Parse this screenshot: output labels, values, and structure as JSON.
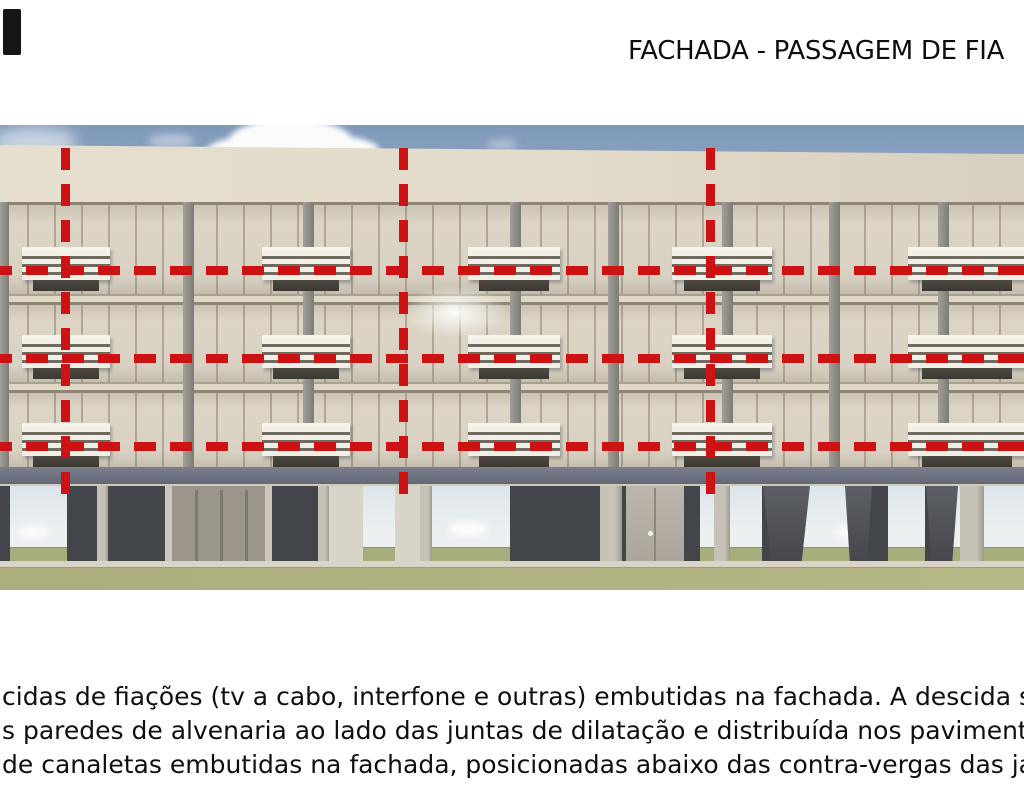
{
  "title": {
    "text": "FACHADA - PASSAGEM DE FIA"
  },
  "figure": {
    "type": "architectural-facade-render",
    "annotation": {
      "color": "#cd1213",
      "horizontal_lines_y": [
        270,
        358,
        446
      ],
      "vertical_lines_x": [
        65,
        403,
        710
      ],
      "vertical_line_top": 148,
      "vertical_line_bottom": 497,
      "dash_length": 22,
      "dash_gap": 14,
      "line_thickness": 9
    },
    "balconies": {
      "columns_x": [
        22,
        262,
        468,
        672,
        908
      ],
      "widths": [
        88,
        88,
        92,
        100,
        118
      ],
      "rows_top_y": [
        247,
        335,
        423
      ],
      "height": 46
    },
    "colors": {
      "sky": "#7f99bb",
      "sky_horizon": "#ecf0f1",
      "facade": "#d8d1c2",
      "parapet": "#e3dccb",
      "window_frame": "#8d8473",
      "pier": "#8a8884",
      "slab_band": "#6f7482",
      "pilotis_wall": "#42454a",
      "column_light": "#bdb8ac",
      "column_dark": "#54575c",
      "grass": "#b0b280",
      "sidewalk": "#d9d4c6",
      "cloud": "#ffffff",
      "annotation_red": "#cd1213",
      "text": "#111111"
    }
  },
  "body_text": {
    "lines": [
      "cidas de fiações (tv a cabo, interfone e outras) embutidas na fachada. A descida será",
      "s paredes de alvenaria ao lado das juntas de dilatação e distribuída nos pavimento at",
      "de canaletas embutidas na fachada, posicionadas abaixo das contra-vergas das jane"
    ]
  }
}
